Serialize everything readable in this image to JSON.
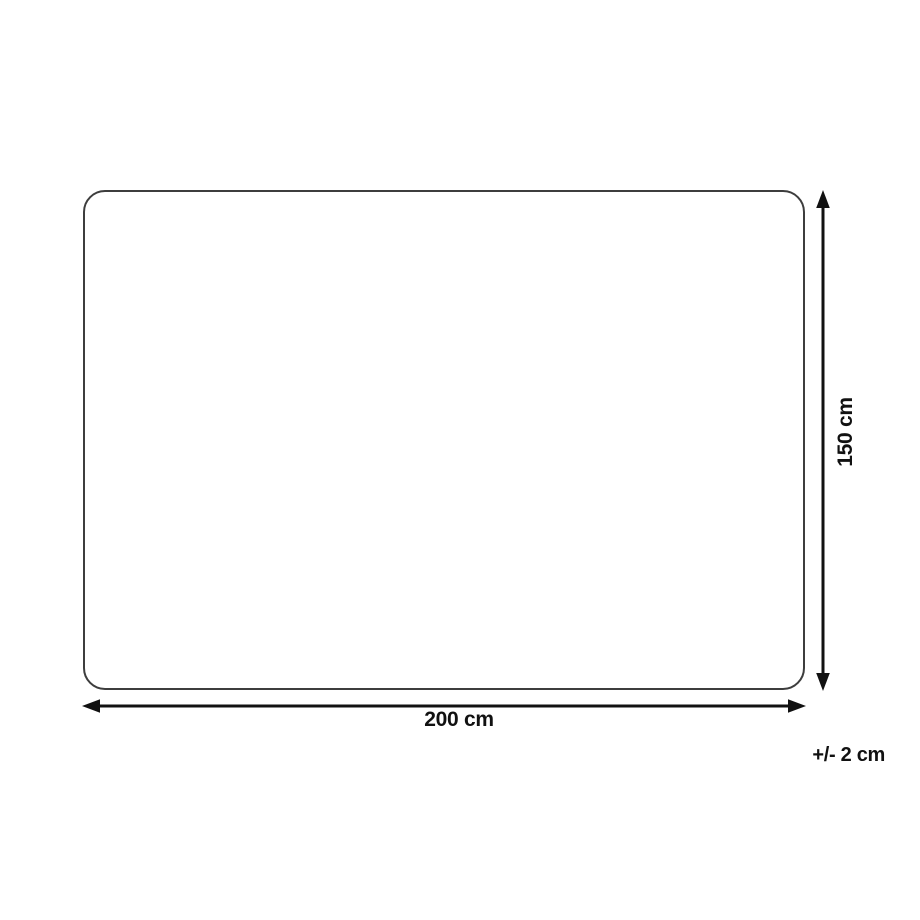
{
  "diagram": {
    "title": "product-dimensions",
    "width_label": "200 cm",
    "height_label": "150 cm",
    "tolerance_label": "+/- 2 cm"
  },
  "colors": {
    "background": "#ffffff",
    "outline": "#3d3d3d",
    "arrow": "#111111"
  }
}
